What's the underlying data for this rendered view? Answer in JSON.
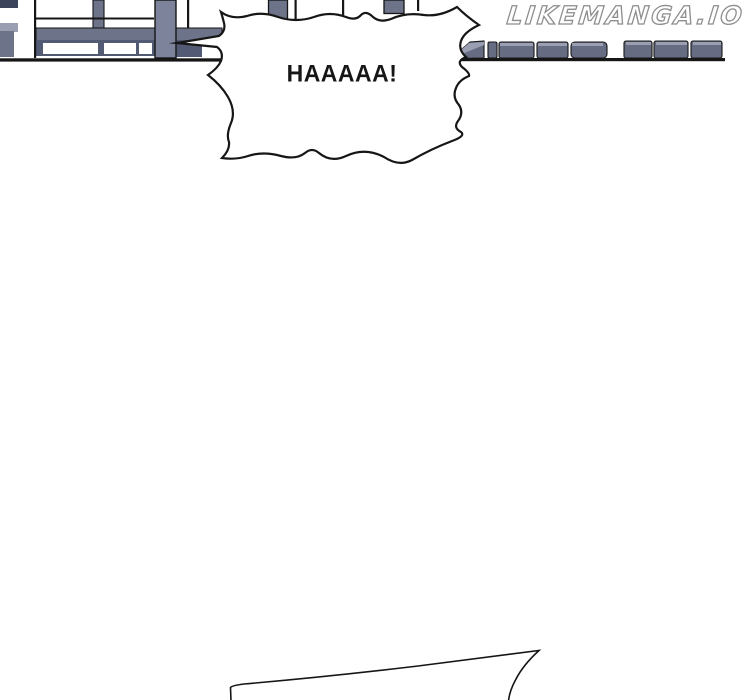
{
  "site_watermark": {
    "text": "LIKEMANGA.IO",
    "fill": "#ffffff",
    "outline": "#8e8e8e"
  },
  "page": {
    "background": "#ffffff",
    "ink": "#161616"
  },
  "artwork": {
    "colors": {
      "panel_mid": "#6d7389",
      "panel_dark": "#535a73",
      "panel_darkest": "#3c445c",
      "panel_light": "#9aa0b2",
      "column": "#7d839b",
      "slab_front": "#666c82",
      "window": "#ffffff"
    }
  },
  "bubbles": {
    "shout": {
      "text": "HAAAAA!",
      "fill": "#ffffff",
      "stroke": "#161616"
    },
    "bottom_partial": {
      "fill": "#ffffff",
      "stroke": "#161616"
    }
  }
}
